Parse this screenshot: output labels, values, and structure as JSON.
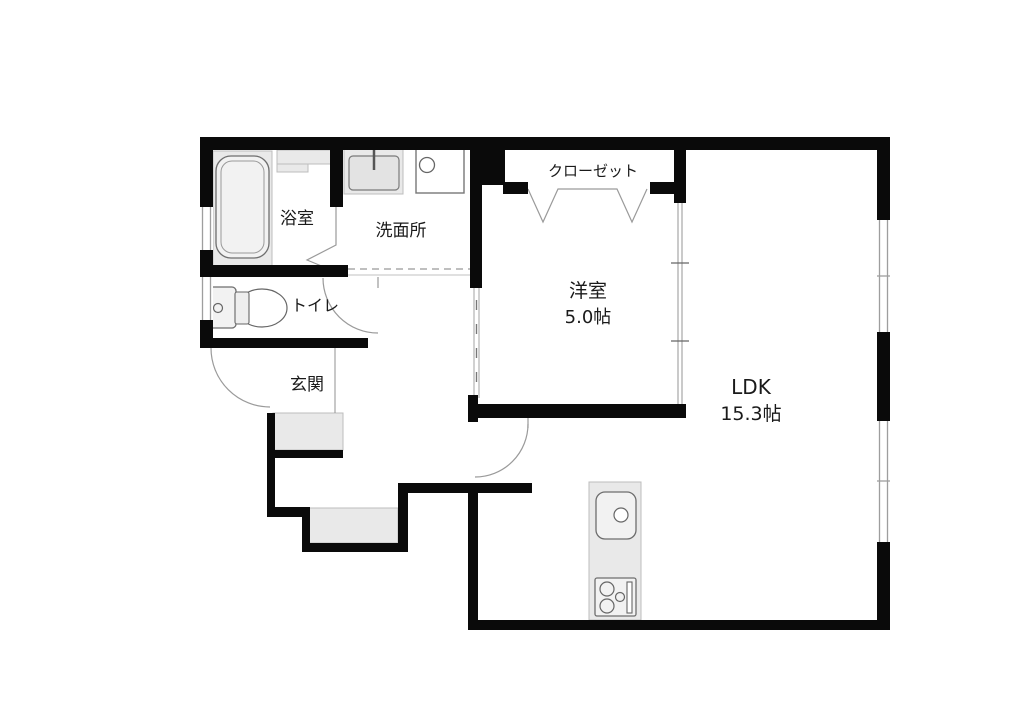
{
  "plan_title": "1LDK floor plan",
  "rooms": {
    "bathroom": {
      "label": "浴室"
    },
    "washroom": {
      "label": "洗面所"
    },
    "closet": {
      "label": "クローゼット"
    },
    "western_room": {
      "label": "洋室",
      "size": "5.0帖"
    },
    "ldk": {
      "label": "LDK",
      "size": "15.3帖"
    },
    "toilet": {
      "label": "トイレ"
    },
    "entrance": {
      "label": "玄関"
    }
  },
  "fixtures": [
    "bathtub",
    "bath-counter",
    "washbasin",
    "washing-machine-pan",
    "toilet-unit",
    "entrance-steps",
    "kitchen-counter",
    "kitchen-sink",
    "gas-stove"
  ],
  "openings": [
    "entrance-door",
    "toilet-door",
    "ldk-door",
    "bathroom-folding-door",
    "closet-bifold-door",
    "sliding-partition",
    "windows"
  ],
  "colors": {
    "wall": "#0a0a0a",
    "room_fill": "#e9e9e9",
    "outline": "#8c8c8c",
    "background": "#ffffff",
    "text": "#1a1a1a"
  }
}
